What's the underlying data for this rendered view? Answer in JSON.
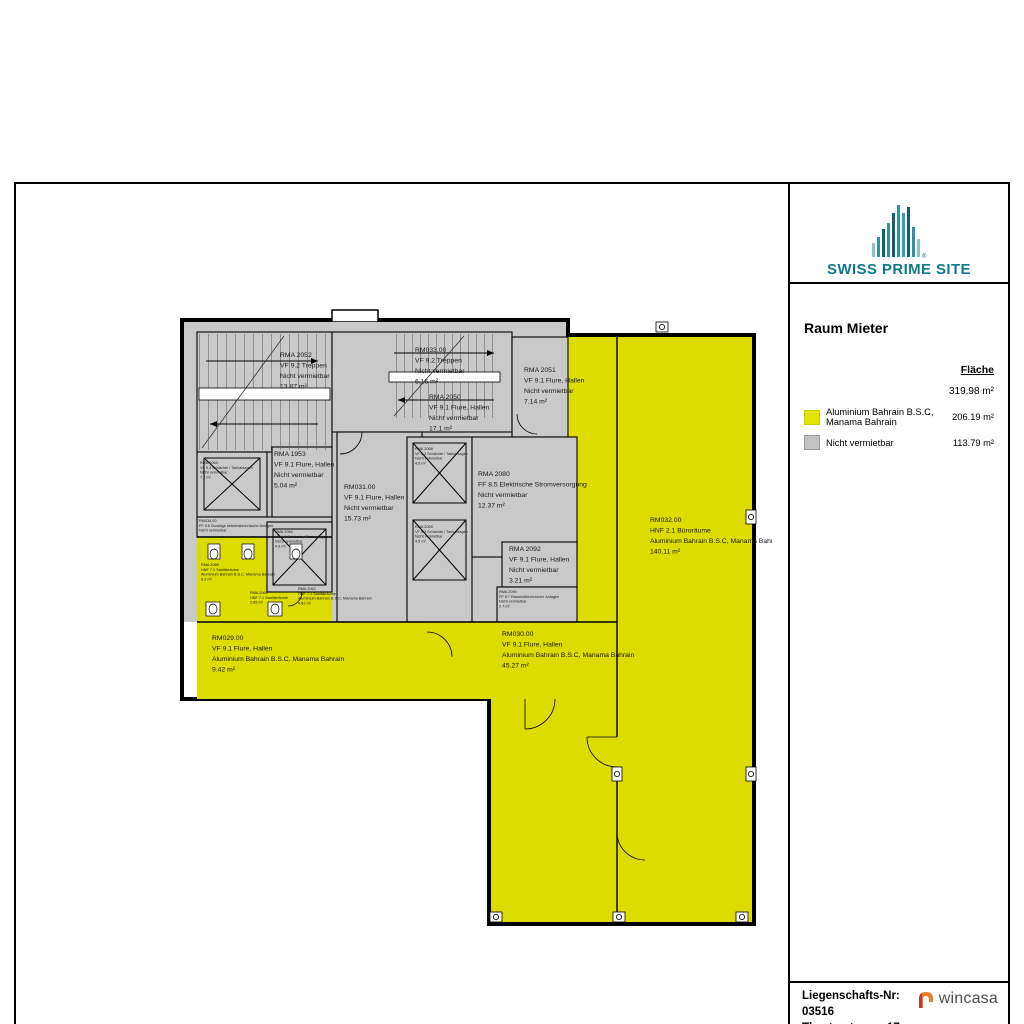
{
  "brand": {
    "name": "SWISS PRIME SITE",
    "registered_mark": "®",
    "teal": "#107a8c"
  },
  "legend": {
    "title": "Raum Mieter",
    "column_header": "Fläche",
    "total": "319.98 m²",
    "rows": [
      {
        "label": "Aluminium Bahrain B.S.C, Manama Bahrain",
        "value": "206.19 m²",
        "color": "#e3e300"
      },
      {
        "label": "Nicht vermietbar",
        "value": "113.79 m²",
        "color": "#c3c3c3"
      }
    ]
  },
  "footer": {
    "property_number": "Liegenschafts-Nr: 03516",
    "address": "Theaterstrasse 17, Winterthur",
    "logo_text": "wincasa",
    "logo_orange": "#ed7d23"
  },
  "colors": {
    "tenant_yellow": "#dcdc00",
    "non_rentable_gray": "#c9c9c9",
    "walls": "#000000"
  },
  "plan": {
    "rooms": {
      "rma2052": {
        "lines": [
          "RMA 2052",
          "VF 9.2 Treppen",
          "Nicht vermietbar",
          "13.87 m²"
        ]
      },
      "rm033": {
        "lines": [
          "RM033.00",
          "VF 9.2 Treppen",
          "Nicht vermietbar",
          "6.16 m²"
        ]
      },
      "rma2050": {
        "lines": [
          "RMA 2050",
          "VF 9.1 Flure, Hallen",
          "Nicht vermietbar",
          "17.1 m²"
        ]
      },
      "rma2051": {
        "lines": [
          "RMA 2051",
          "VF 9.1 Flure, Hallen",
          "Nicht vermietbar",
          "7.14 m²"
        ]
      },
      "rma1953": {
        "lines": [
          "RMA 1953",
          "VF 9.1 Flure, Hallen",
          "Nicht vermietbar",
          "5.04 m²"
        ]
      },
      "rm031": {
        "lines": [
          "RM031.00",
          "VF 9.1 Flure, Hallen",
          "Nicht vermietbar",
          "15.73 m²"
        ]
      },
      "rma2080": {
        "lines": [
          "RMA 2080",
          "FF 8.5 Elektrische Stromversorgung",
          "Nicht vermietbar",
          "12.37 m²"
        ]
      },
      "rma2092": {
        "lines": [
          "RMA 2092",
          "VF 9.1 Flure, Hallen",
          "Nicht vermietbar",
          "3.21 m²"
        ]
      },
      "rma2090": {
        "lines": [
          "RMA 2090",
          "FF 8.7 Raumlufttechnische Anlagen",
          "Nicht vermietbar",
          "2.7 m²"
        ]
      },
      "rm029": {
        "lines": [
          "RM029.00",
          "VF 9.1 Flure, Hallen",
          "Aluminium Bahrain B.S.C, Manama Bahrain",
          "9.42 m²"
        ]
      },
      "rm030": {
        "lines": [
          "RM030.00",
          "VF 9.1 Flure, Hallen",
          "Aluminium Bahrain B.S.C, Manama Bahrain",
          "45.27 m²"
        ]
      },
      "rm032": {
        "lines": [
          "RM032.00",
          "HNF 2.1 Büroräume",
          "Aluminium Bahrain B.S.C, Manama Bahrain",
          "140.11 m²"
        ]
      },
      "shaft_left": {
        "lines": [
          "RMA 2063",
          "VF 9.3 Schächte / Tankanlagen",
          "Nicht vermietbar",
          "7.2 m²"
        ]
      },
      "tech_band": {
        "lines": [
          "RM034.00",
          "FF 9.6 Sonstige betriebstechnische Anlagen",
          "Nicht vermietbar"
        ]
      },
      "wc_left": {
        "lines": [
          "RMA 2065",
          "HNF 7.1 Sanitärräume",
          "Aluminium Bahrain B.S.C, Manama Bahrain",
          "6.3 m²"
        ]
      },
      "wc_mid": {
        "lines": [
          "RMA 2066",
          "HNF 7.1 Sanitärräume",
          "2.65 m²"
        ]
      },
      "wc_right": {
        "lines": [
          "RMA 2062",
          "HNF 7.1 Sanitärräume",
          "Aluminium Bahrain B.S.C, Manama Bahrain",
          "4.62 m²"
        ]
      },
      "shaft_c1": {
        "lines": [
          "RMA 2068",
          "VF 9.3 Schächte / Tankanlagen",
          "Nicht vermietbar",
          "4.5 m²"
        ]
      },
      "shaft_c2": {
        "lines": [
          "RMA 2069",
          "VF 9.3 Schächte / Tankanlagen",
          "Nicht vermietbar",
          "4.5 m²"
        ]
      },
      "shaft_cl": {
        "lines": [
          "RMA 2064",
          "VF 9.3 Schächte / Tankanlagen",
          "Nicht vermietbar",
          "4.9 m²"
        ]
      }
    }
  }
}
